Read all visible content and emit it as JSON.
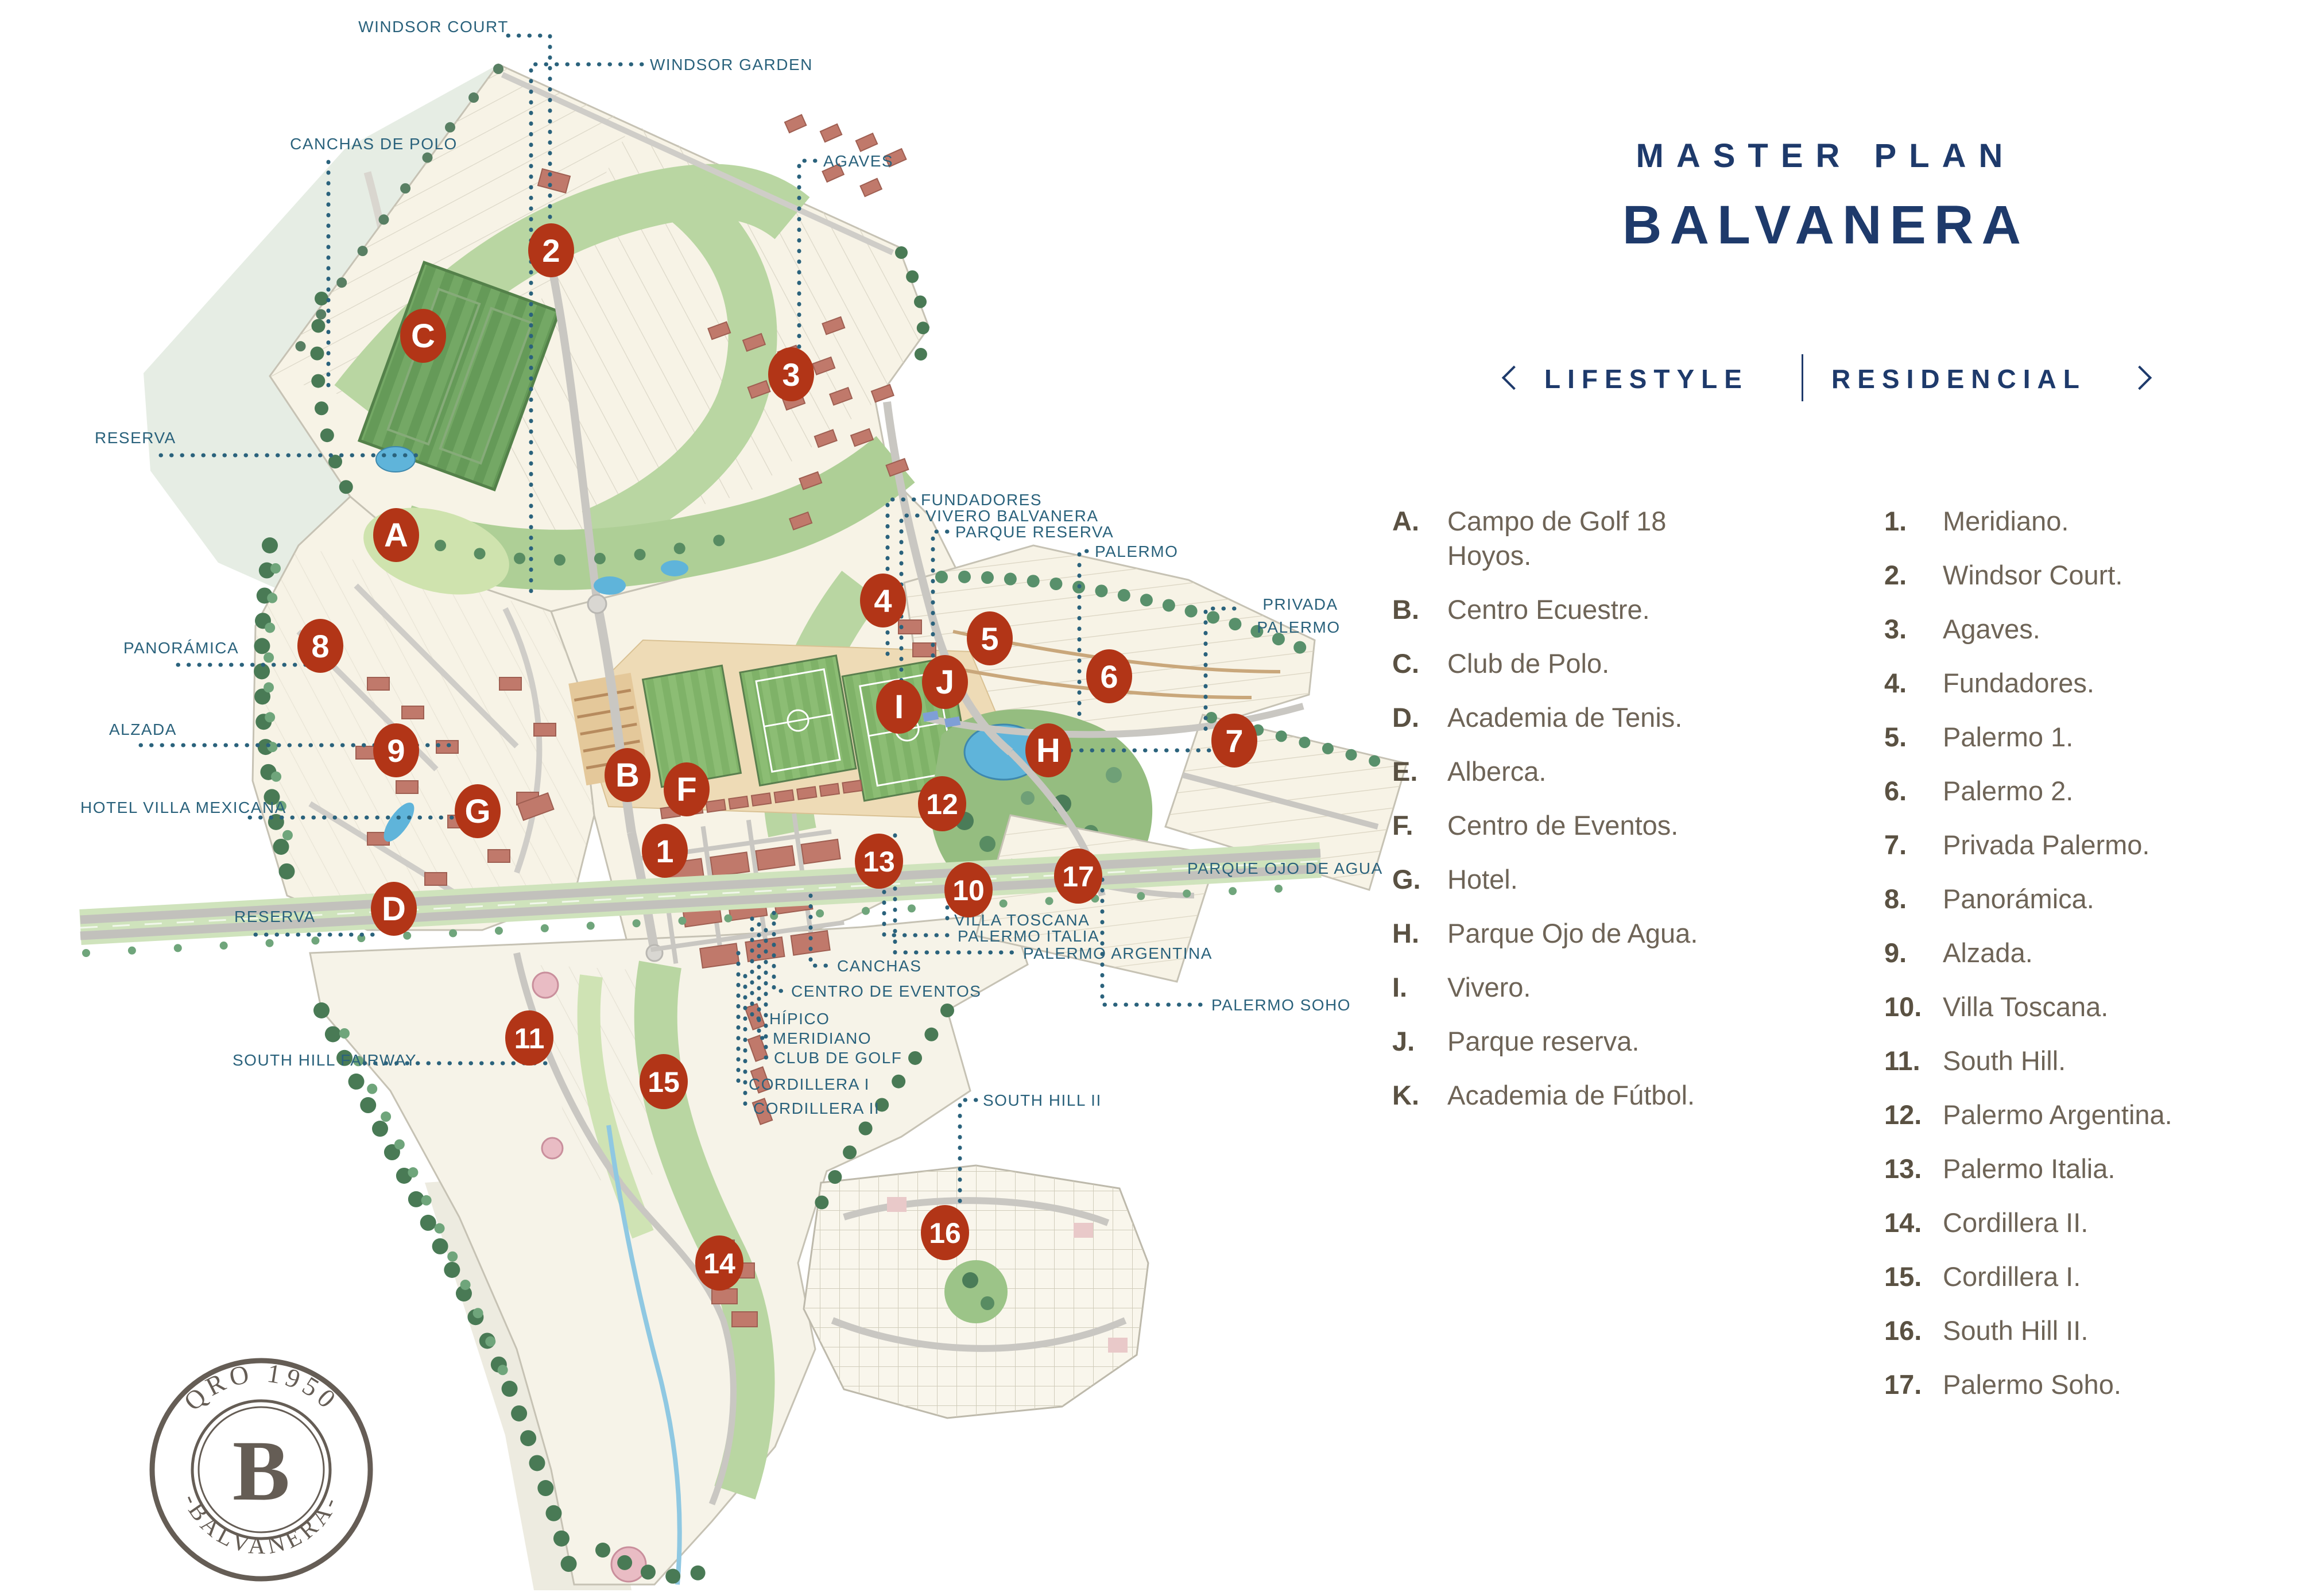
{
  "header": {
    "kicker": "MASTER PLAN",
    "title": "BALVANERA"
  },
  "nav": {
    "prev": "previous",
    "lifestyle": "LIFESTYLE",
    "residencial": "RESIDENCIAL",
    "next": "next"
  },
  "legend": {
    "facilities": [
      {
        "key": "A.",
        "label": "Campo de Golf 18 Hoyos."
      },
      {
        "key": "B.",
        "label": "Centro Ecuestre."
      },
      {
        "key": "C.",
        "label": "Club de Polo."
      },
      {
        "key": "D.",
        "label": "Academia de Tenis."
      },
      {
        "key": "E.",
        "label": "Alberca."
      },
      {
        "key": "F.",
        "label": "Centro de Eventos."
      },
      {
        "key": "G.",
        "label": "Hotel."
      },
      {
        "key": "H.",
        "label": "Parque Ojo de Agua."
      },
      {
        "key": "I.",
        "label": "Vivero."
      },
      {
        "key": "J.",
        "label": "Parque reserva."
      },
      {
        "key": "K.",
        "label": "Academia de Fútbol."
      }
    ],
    "residences": [
      {
        "key": "1.",
        "label": "Meridiano."
      },
      {
        "key": "2.",
        "label": "Windsor Court."
      },
      {
        "key": "3.",
        "label": "Agaves."
      },
      {
        "key": "4.",
        "label": "Fundadores."
      },
      {
        "key": "5.",
        "label": "Palermo 1."
      },
      {
        "key": "6.",
        "label": "Palermo 2."
      },
      {
        "key": "7.",
        "label": "Privada Palermo."
      },
      {
        "key": "8.",
        "label": "Panorámica."
      },
      {
        "key": "9.",
        "label": "Alzada."
      },
      {
        "key": "10.",
        "label": "Villa Toscana."
      },
      {
        "key": "11.",
        "label": "South Hill."
      },
      {
        "key": "12.",
        "label": "Palermo Argentina."
      },
      {
        "key": "13.",
        "label": "Palermo Italia."
      },
      {
        "key": "14.",
        "label": "Cordillera II."
      },
      {
        "key": "15.",
        "label": "Cordillera I."
      },
      {
        "key": "16.",
        "label": "South Hill II."
      },
      {
        "key": "17.",
        "label": "Palermo Soho."
      }
    ]
  },
  "map": {
    "labels": {
      "windsor_court": "WINDSOR COURT",
      "windsor_garden": "WINDSOR GARDEN",
      "canchas_de_polo": "CANCHAS DE POLO",
      "agaves": "AGAVES",
      "reserva": "RESERVA",
      "panoramica": "PANORÁMICA",
      "alzada": "ALZADA",
      "hotel_villa_mexicana": "HOTEL VILLA MEXICANA",
      "reserva2": "RESERVA",
      "south_hill_fairway": "SOUTH HILL FAIRWAY",
      "fundadores": "FUNDADORES",
      "vivero_balvanera": "VIVERO BALVANERA",
      "parque_reserva": "PARQUE RESERVA",
      "palermo": "PALERMO",
      "privada1": "PRIVADA",
      "privada2": "PALERMO",
      "parque_ojo_de_agua": "PARQUE OJO DE AGUA",
      "villa_toscana": "VILLA TOSCANA",
      "palermo_italia": "PALERMO ITALIA",
      "palermo_argentina": "PALERMO ARGENTINA",
      "canchas": "CANCHAS",
      "centro_de_eventos": "CENTRO DE EVENTOS",
      "hipico": "HÍPICO",
      "meridiano": "MERIDIANO",
      "club_de_golf": "CLUB DE GOLF",
      "cordillera_i": "CORDILLERA I",
      "cordillera_ii": "CORDILLERA II",
      "palermo_soho": "PALERMO SOHO",
      "south_hill_ii": "SOUTH HILL II"
    },
    "markers": {
      "A": "A",
      "B": "B",
      "C": "C",
      "D": "D",
      "F": "F",
      "G": "G",
      "H": "H",
      "I": "I",
      "J": "J",
      "n1": "1",
      "n2": "2",
      "n3": "3",
      "n4": "4",
      "n5": "5",
      "n6": "6",
      "n7": "7",
      "n8": "8",
      "n9": "9",
      "n10": "10",
      "n11": "11",
      "n12": "12",
      "n13": "13",
      "n14": "14",
      "n15": "15",
      "n16": "16",
      "n17": "17"
    },
    "colors": {
      "marker": "#b23517",
      "label": "#2a627c",
      "accent": "#1e3a6b"
    }
  },
  "stamp": {
    "arc_top": "QRO 1950",
    "center": "B",
    "arc_bottom": "-BALVANERA-"
  }
}
